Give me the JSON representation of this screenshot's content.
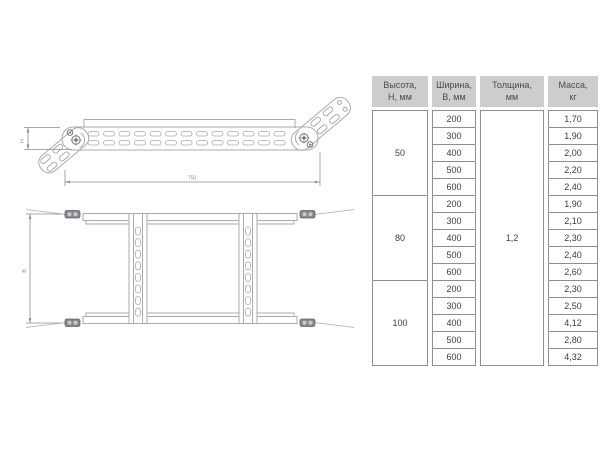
{
  "drawing": {
    "dim_length": "750",
    "dim_height": "H",
    "dim_width": "B"
  },
  "table": {
    "headers": [
      "Высота,\nН, мм",
      "Ширина,\nВ, мм",
      "Толщина,\nмм",
      "Масса,\nкг"
    ],
    "thickness": "1,2",
    "groups": [
      {
        "height": "50",
        "rows": [
          [
            "200",
            "1,70"
          ],
          [
            "300",
            "1,90"
          ],
          [
            "400",
            "2,00"
          ],
          [
            "500",
            "2,20"
          ],
          [
            "600",
            "2,40"
          ]
        ]
      },
      {
        "height": "80",
        "rows": [
          [
            "200",
            "1,90"
          ],
          [
            "300",
            "2,10"
          ],
          [
            "400",
            "2,30"
          ],
          [
            "500",
            "2,40"
          ],
          [
            "600",
            "2,60"
          ]
        ]
      },
      {
        "height": "100",
        "rows": [
          [
            "200",
            "2,30"
          ],
          [
            "300",
            "2,50"
          ],
          [
            "400",
            "4,12"
          ],
          [
            "500",
            "2,80"
          ],
          [
            "600",
            "4,32"
          ]
        ]
      }
    ]
  }
}
